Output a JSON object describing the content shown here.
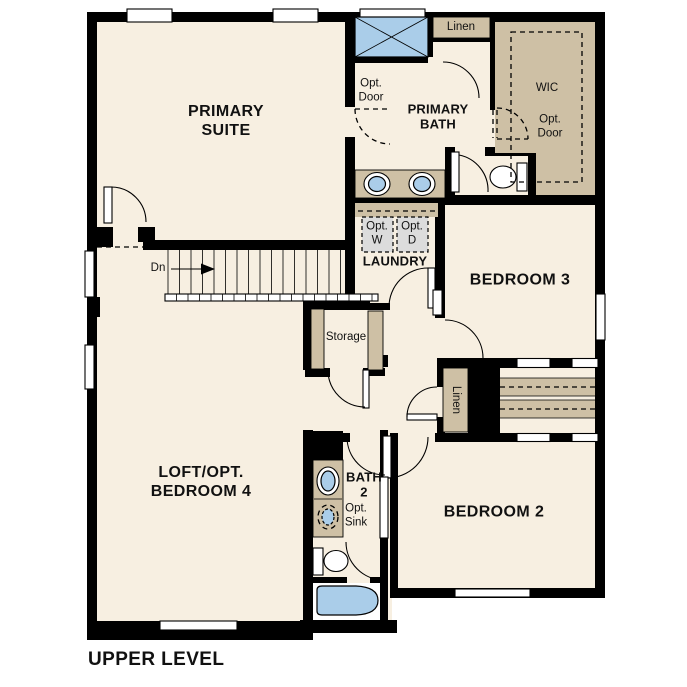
{
  "title": "UPPER LEVEL",
  "colors": {
    "wall": "#000000",
    "floor": "#f7efe1",
    "accent_tan": "#cec0a5",
    "fixture_blue": "#aacde9",
    "appliance_gray": "#dcdcdc",
    "background": "#ffffff"
  },
  "labels": {
    "primary_suite": "PRIMARY\nSUITE",
    "primary_bath": "PRIMARY\nBATH",
    "wic": "WIC",
    "opt_door_bath": "Opt.\nDoor",
    "opt_door_wic": "Opt.\nDoor",
    "linen_top": "Linen",
    "laundry": "LAUNDRY",
    "opt_washer": "Opt.\nW",
    "opt_dryer": "Opt.\nD",
    "bedroom_3": "BEDROOM 3",
    "storage": "Storage",
    "linen_closet": "Linen",
    "loft": "LOFT/OPT.\nBEDROOM 4",
    "bath_2": "BATH\n2",
    "opt_sink": "Opt.\nSink",
    "bedroom_2": "BEDROOM 2",
    "down": "Dn"
  }
}
